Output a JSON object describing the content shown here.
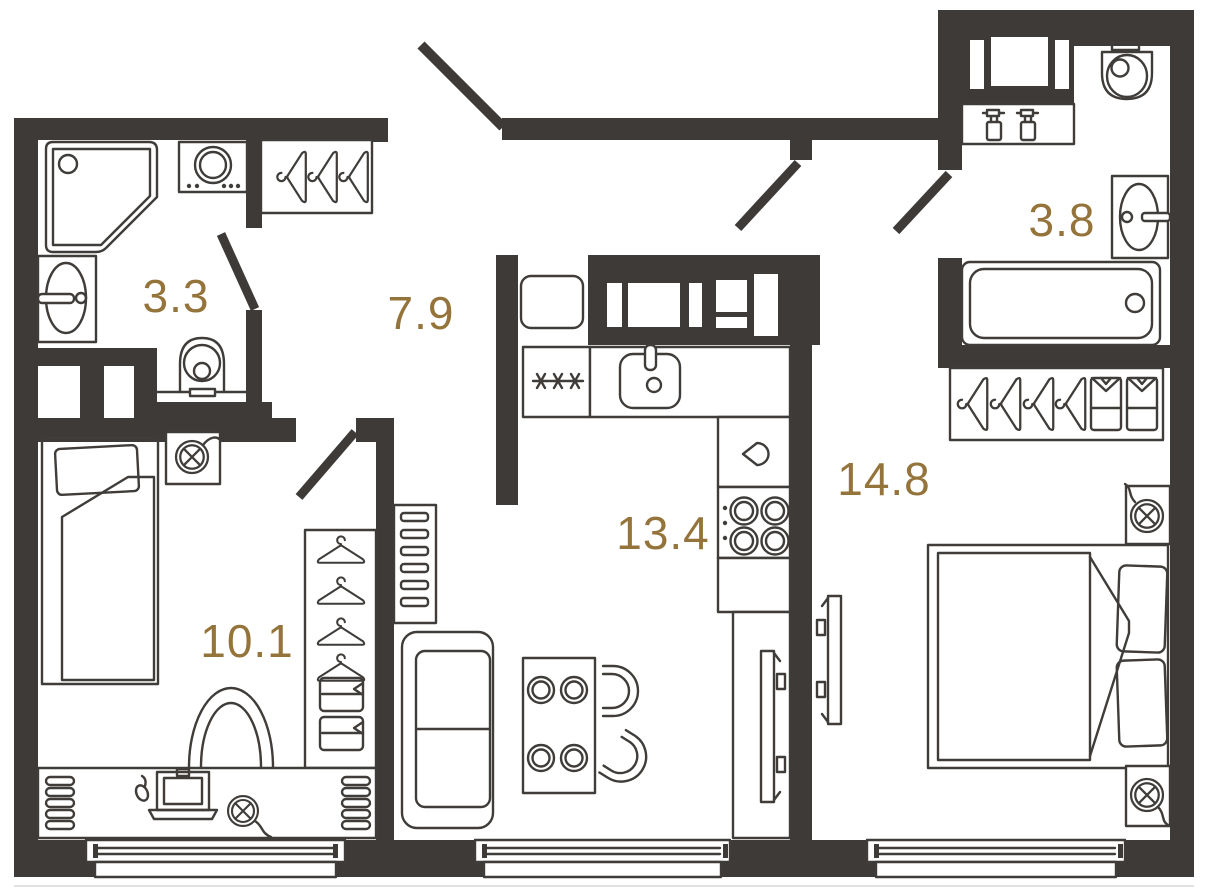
{
  "title": "Apartment floor plan",
  "canvas": {
    "width": 1208,
    "height": 892
  },
  "colors": {
    "wall": "#3d3a37",
    "line": "#3f3c39",
    "label": "#94743b",
    "background": "#ffffff"
  },
  "rooms": [
    {
      "id": "bathroom-1",
      "area": "3.3",
      "fixtures": [
        "shower",
        "washing-machine",
        "sink",
        "toilet",
        "door-swing"
      ]
    },
    {
      "id": "hallway",
      "area": "7.9",
      "fixtures": [
        "hanger-rack",
        "fridge",
        "entrance-door-swing"
      ]
    },
    {
      "id": "bathroom-2",
      "area": "3.8",
      "fixtures": [
        "washer-niche",
        "spray-bottles-shelf",
        "toilet",
        "sink",
        "bathtub",
        "wardrobe-hangers-shirts",
        "door-swing"
      ]
    },
    {
      "id": "bedroom-1",
      "area": "10.1",
      "fixtures": [
        "single-bed",
        "wall-lamp",
        "wardrobe-hangers-drawers",
        "chair",
        "desk",
        "laptop",
        "mouse",
        "desk-lamp",
        "radiator-left",
        "radiator-right",
        "door-swing"
      ]
    },
    {
      "id": "kitchen-living",
      "area": "13.4",
      "fixtures": [
        "utility-shaft",
        "freezer-snowflakes",
        "kitchen-sink",
        "kettle",
        "stove-4-burners",
        "tv-console",
        "tv",
        "sofa",
        "dining-table-cups",
        "chairs",
        "shelf-rack"
      ]
    },
    {
      "id": "bedroom-2",
      "area": "14.8",
      "fixtures": [
        "double-bed",
        "pillows",
        "nightstand-lamp-top",
        "nightstand-lamp-bottom",
        "tv",
        "door-swing"
      ]
    }
  ],
  "counts": {
    "windows": 3,
    "door_swings": 5
  }
}
